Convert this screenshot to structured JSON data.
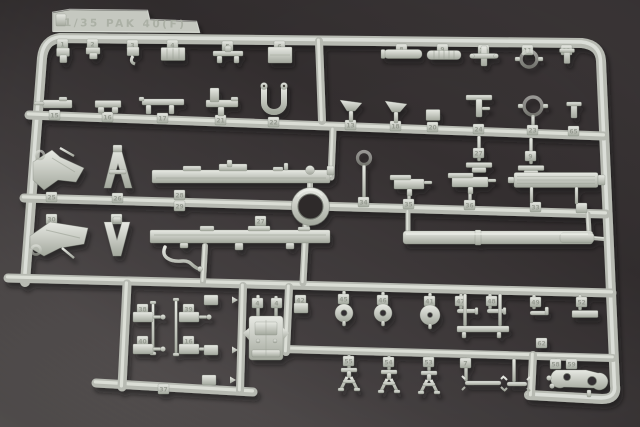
{
  "meta": {
    "description": "Photograph of a light grey injection moulded styrene sprue (parts tree) of a 1/35 scale PaK 40 anti tank gun model kit, lying on a dark grey cloth background",
    "subject": "model kit sprue",
    "scale_label": "1/35"
  },
  "colors": {
    "background_dark": "#2e2a2b",
    "background_mid": "#413c3d",
    "background_light": "#6f6a69",
    "plastic_base": "#c3c7bf",
    "plastic_light": "#e7e9e3",
    "plastic_dark": "#9aa094",
    "plastic_edge": "#7e837a",
    "emboss_text": "#a9aea3",
    "part_number_text": "#8f948a",
    "shadow": "#141213"
  },
  "label_tab": {
    "text": "1/35 PAK 40(F)",
    "polygon": "53,32 53,13 70,10 148,11 150,20 197,22 200,33"
  },
  "ring": {
    "cx": 310.5,
    "cy": 206.5,
    "r_outer": 19,
    "r_inner": 12.5
  },
  "frame": {
    "path": "M 25 282 L 42 58 Q 44 40 60 38 L 582 43 Q 600 45 601 61 L 615 386 Q 617 399 602 399 L 529 395",
    "width": 10
  },
  "runners": [
    [
      29,
      115,
      604,
      136,
      9
    ],
    [
      24,
      198,
      606,
      214,
      9
    ],
    [
      8,
      278,
      612,
      293,
      9
    ],
    [
      284,
      349,
      613,
      358,
      8
    ],
    [
      96,
      383,
      253,
      392,
      9
    ]
  ],
  "verticals": [
    [
      319,
      41,
      322,
      121,
      8
    ],
    [
      333,
      130,
      331,
      177,
      7
    ],
    [
      310,
      174,
      310,
      190,
      6
    ],
    [
      306,
      225,
      303,
      283,
      7
    ],
    [
      289,
      287,
      286,
      352,
      8
    ],
    [
      127,
      284,
      122,
      387,
      9
    ],
    [
      243,
      286,
      240,
      391,
      8
    ],
    [
      533,
      355,
      531,
      396,
      8
    ],
    [
      205,
      246,
      203,
      282,
      6
    ],
    [
      408,
      212,
      408,
      231,
      5
    ],
    [
      588,
      214,
      589,
      232,
      5
    ],
    [
      592,
      238,
      604,
      239,
      4
    ]
  ],
  "runner_tabs": [
    [
      158,
      384,
      "37"
    ]
  ],
  "parts": [
    {
      "t": "clip",
      "x": 63,
      "y": 55,
      "w": 13,
      "h": 14,
      "tab": [
        57,
        39,
        "1"
      ]
    },
    {
      "t": "clip",
      "x": 93,
      "y": 53,
      "w": 14,
      "h": 11,
      "tab": [
        87,
        39,
        "2"
      ]
    },
    {
      "t": "hook",
      "x": 133,
      "y": 55,
      "w": 12,
      "h": 16,
      "tab": [
        127,
        40,
        "3"
      ]
    },
    {
      "t": "texbox",
      "x": 173,
      "y": 54,
      "w": 24,
      "h": 13,
      "tab": [
        167,
        40,
        "4"
      ]
    },
    {
      "t": "tbar",
      "x": 228,
      "y": 53,
      "w": 30,
      "h": 13,
      "tab": [
        222,
        41,
        "5"
      ]
    },
    {
      "t": "plate",
      "x": 280,
      "y": 55,
      "w": 24,
      "h": 16,
      "tab": [
        274,
        41,
        "6"
      ]
    },
    {
      "t": "cylbar",
      "x": 403,
      "y": 54,
      "w": 38,
      "h": 9,
      "tab": [
        396,
        44,
        "8"
      ],
      "stem": [
        403,
        46,
        51
      ]
    },
    {
      "t": "ribbed",
      "x": 444,
      "y": 55,
      "w": 34,
      "h": 9,
      "tab": [
        437,
        44,
        "9"
      ],
      "stem": [
        444,
        46,
        52
      ]
    },
    {
      "t": "cross",
      "x": 484,
      "y": 56,
      "w": 24,
      "h": 20,
      "tab": [
        478,
        45,
        "10"
      ]
    },
    {
      "t": "sight",
      "x": 529,
      "y": 59,
      "r": 8,
      "tab": [
        522,
        45,
        "11"
      ],
      "stem": [
        529,
        47,
        52
      ]
    },
    {
      "t": "smallT",
      "x": 567,
      "y": 56,
      "w": 15,
      "h": 15,
      "tab": [
        561,
        45,
        "12"
      ]
    },
    {
      "t": "mg",
      "x": 55,
      "y": 104,
      "w": 34,
      "h": 11,
      "tab": [
        49,
        110,
        "15"
      ]
    },
    {
      "t": "bracket2",
      "x": 108,
      "y": 104,
      "w": 26,
      "h": 11,
      "tab": [
        102,
        112,
        "16"
      ]
    },
    {
      "t": "bench",
      "x": 163,
      "y": 103,
      "w": 42,
      "h": 15,
      "tab": [
        157,
        113,
        "17"
      ]
    },
    {
      "t": "seat",
      "x": 221,
      "y": 100,
      "w": 34,
      "h": 24,
      "tab": [
        215,
        115,
        "21"
      ]
    },
    {
      "t": "ubracket",
      "x": 274,
      "y": 99,
      "w": 26,
      "h": 27,
      "tab": [
        268,
        117,
        "22"
      ]
    },
    {
      "t": "funnel",
      "x": 351,
      "y": 109,
      "w": 22,
      "h": 18,
      "tab": [
        345,
        120,
        "13"
      ]
    },
    {
      "t": "funnel",
      "x": 396,
      "y": 110,
      "w": 22,
      "h": 18,
      "tab": [
        390,
        121,
        "18"
      ]
    },
    {
      "t": "box",
      "x": 433,
      "y": 115,
      "w": 14,
      "h": 11,
      "tab": [
        427,
        122,
        "20"
      ]
    },
    {
      "t": "tpost",
      "x": 479,
      "y": 106,
      "w": 26,
      "h": 22,
      "tab": [
        473,
        124,
        "24"
      ]
    },
    {
      "t": "sight",
      "x": 533,
      "y": 106,
      "r": 9,
      "tab": [
        527,
        125,
        "23"
      ],
      "stem": [
        533,
        115,
        128
      ]
    },
    {
      "t": "smallT",
      "x": 574,
      "y": 110,
      "w": 15,
      "h": 16,
      "tab": [
        568,
        126,
        "65"
      ]
    },
    {
      "t": "crossfoot",
      "x": 479,
      "y": 165,
      "tab": [
        473,
        148,
        "27"
      ],
      "stem": [
        479,
        136,
        161
      ]
    },
    {
      "t": "crossfoot",
      "x": 531,
      "y": 168,
      "tab": [
        525,
        151,
        "9"
      ],
      "stem": [
        531,
        138,
        164
      ]
    },
    {
      "t": "keypart",
      "x": 364,
      "y": 158,
      "tab": [
        358,
        197,
        "34"
      ],
      "stem": [
        364,
        165,
        202
      ]
    },
    {
      "t": "mgpart",
      "x": 409,
      "y": 184,
      "w": 30,
      "h": 16,
      "tab": [
        403,
        199,
        "35"
      ],
      "stem": [
        409,
        192,
        204
      ]
    },
    {
      "t": "mgpart",
      "x": 470,
      "y": 182,
      "w": 36,
      "h": 18,
      "tab": [
        464,
        200,
        "36"
      ],
      "stem": [
        470,
        191,
        205
      ]
    },
    {
      "t": "recoil",
      "x": 556,
      "y": 180,
      "w": 84,
      "h": 15,
      "tabs": [
        [
          530,
          202,
          "33"
        ],
        [
          576,
          203,
          ""
        ]
      ]
    },
    {
      "t": "spade1",
      "x": 57,
      "y": 168,
      "tab": [
        46,
        192,
        "25"
      ]
    },
    {
      "t": "aframe",
      "x": 118,
      "y": 168,
      "tab": [
        112,
        193,
        "26"
      ]
    },
    {
      "t": "beam",
      "x": 241,
      "y": 176,
      "w": 178,
      "tabs": [
        [
          174,
          190,
          "28"
        ],
        [
          174,
          201,
          "29"
        ]
      ]
    },
    {
      "t": "spade2",
      "x": 57,
      "y": 238,
      "tab": [
        46,
        214,
        "30"
      ]
    },
    {
      "t": "vpart",
      "x": 117,
      "y": 239,
      "tab": [
        111,
        214,
        "31"
      ]
    },
    {
      "t": "beam2",
      "x": 240,
      "y": 236,
      "w": 180,
      "tab": [
        255,
        216,
        "27"
      ]
    },
    {
      "t": "srod",
      "x": 182,
      "y": 256
    },
    {
      "t": "ballknob",
      "x": 310,
      "y": 170,
      "r": 4.5
    },
    {
      "t": "barrel",
      "x": 497,
      "y": 237
    },
    {
      "t": "washer",
      "x": 344,
      "y": 313,
      "r": 9,
      "hole": 3,
      "tab": [
        338,
        294,
        "45"
      ],
      "stem": [
        344,
        291,
        304
      ]
    },
    {
      "t": "washer",
      "x": 383,
      "y": 313,
      "r": 9,
      "hole": 3,
      "tab": [
        377,
        295,
        "46"
      ],
      "stem": [
        383,
        292,
        304
      ]
    },
    {
      "t": "washer",
      "x": 430,
      "y": 315,
      "r": 10,
      "hole": 2.5,
      "tab": [
        424,
        296,
        "41"
      ],
      "stem": [
        430,
        293,
        305
      ]
    },
    {
      "t": "hpin",
      "x": 467,
      "y": 311,
      "w": 20,
      "tab": [
        455,
        296,
        "47"
      ],
      "stem": [
        461,
        294,
        309
      ]
    },
    {
      "t": "hpin",
      "x": 496,
      "y": 311,
      "w": 18,
      "tab": [
        486,
        296,
        "48"
      ],
      "stem": [
        490,
        294,
        309
      ]
    },
    {
      "t": "lpin",
      "x": 539,
      "y": 313,
      "tab": [
        530,
        297,
        "49"
      ],
      "stem": [
        534,
        295,
        309
      ]
    },
    {
      "t": "flatbar",
      "x": 585,
      "y": 314,
      "w": 26,
      "h": 7,
      "tab": [
        576,
        297,
        "52"
      ],
      "stem": [
        580,
        295,
        310
      ]
    },
    {
      "t": "bench3",
      "x": 483,
      "y": 330,
      "w": 52,
      "tab": [
        536,
        338,
        "62"
      ],
      "stems": [
        [
          465,
          294,
          326
        ],
        [
          500,
          294,
          326
        ]
      ]
    },
    {
      "t": "box",
      "x": 301,
      "y": 308,
      "w": 14,
      "h": 10,
      "tab": [
        295,
        295,
        "42"
      ],
      "stem": [
        301,
        297,
        303
      ]
    },
    {
      "t": "rodthin",
      "x": 153,
      "y": 328,
      "h": 50
    },
    {
      "t": "rodthin",
      "x": 176,
      "y": 327,
      "h": 54
    },
    {
      "t": "lbracket",
      "x": 143,
      "y": 317,
      "tab": [
        137,
        304,
        "38"
      ]
    },
    {
      "t": "lbracket",
      "x": 189,
      "y": 317,
      "tab": [
        183,
        304,
        "39"
      ]
    },
    {
      "t": "lbracket",
      "x": 143,
      "y": 349,
      "tab": [
        137,
        336,
        "40"
      ]
    },
    {
      "t": "lbracket",
      "x": 189,
      "y": 349,
      "tab": [
        183,
        336,
        "16"
      ]
    },
    {
      "t": "arrowbr",
      "x": 216,
      "y": 300
    },
    {
      "t": "arrowbr",
      "x": 216,
      "y": 350
    },
    {
      "t": "arrowbr",
      "x": 214,
      "y": 380
    },
    {
      "t": "mount",
      "x": 266,
      "y": 338,
      "stems": [
        [
          258,
          295,
          317
        ],
        [
          276,
          296,
          317
        ]
      ],
      "tabs": [
        [
          252,
          298,
          "4"
        ],
        [
          271,
          298,
          "4"
        ]
      ]
    },
    {
      "t": "tripod",
      "x": 349,
      "y": 379,
      "tab": [
        343,
        356,
        "55"
      ],
      "stem": [
        349,
        355,
        369
      ]
    },
    {
      "t": "tripod",
      "x": 389,
      "y": 381,
      "tab": [
        383,
        357,
        "54"
      ],
      "stem": [
        389,
        356,
        370
      ]
    },
    {
      "t": "tripod",
      "x": 429,
      "y": 382,
      "tab": [
        423,
        357,
        "53"
      ],
      "stem": [
        429,
        357,
        371
      ]
    },
    {
      "t": "forkpin",
      "x": 483,
      "y": 383,
      "w": 36,
      "tab": [
        460,
        358,
        "7"
      ],
      "stem": [
        466,
        358,
        381
      ]
    },
    {
      "t": "forkpin",
      "x": 517,
      "y": 384,
      "w": 20,
      "stem": [
        514,
        359,
        382
      ]
    },
    {
      "t": "pinfoot",
      "x": 556,
      "y": 371,
      "tab": [
        550,
        359,
        "58"
      ],
      "stem": [
        556,
        359,
        368
      ]
    },
    {
      "t": "plate61",
      "x": 578,
      "y": 380,
      "tab": [
        566,
        359,
        "59"
      ]
    }
  ]
}
